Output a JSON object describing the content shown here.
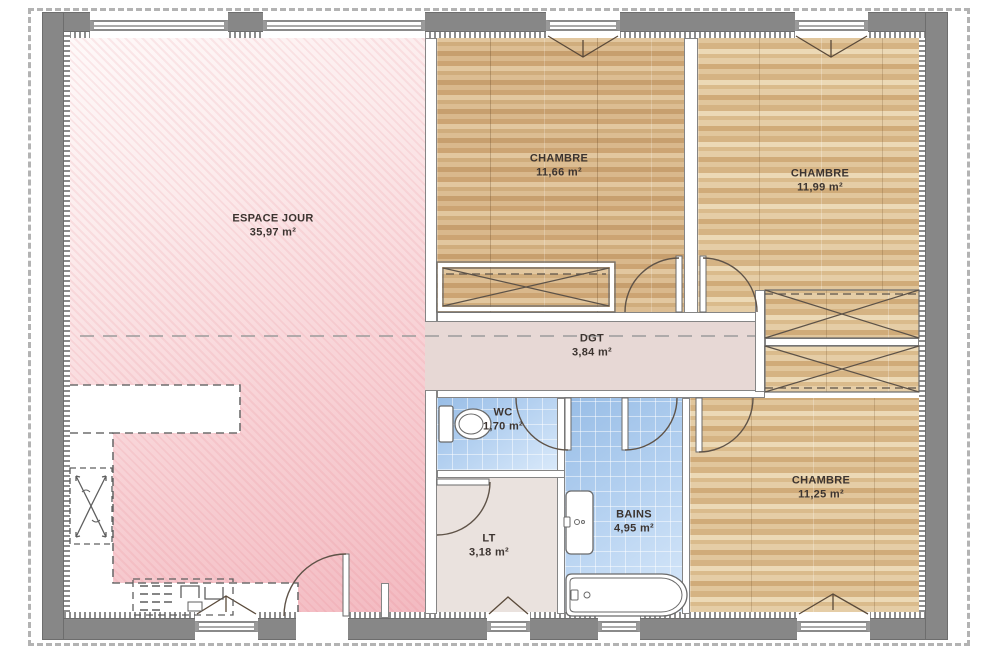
{
  "plan": {
    "title": "Plan de maison - rez-de-chaussée",
    "rooms": {
      "espaceJour": {
        "name": "ESPACE JOUR",
        "area": "35,97 m²"
      },
      "chambre1": {
        "name": "CHAMBRE",
        "area": "11,66 m²"
      },
      "chambre2": {
        "name": "CHAMBRE",
        "area": "11,99 m²"
      },
      "degagement": {
        "name": "DGT",
        "area": "3,84 m²"
      },
      "wc": {
        "name": "WC",
        "area": "1,70 m²"
      },
      "lt": {
        "name": "LT",
        "area": "3,18 m²"
      },
      "bains": {
        "name": "BAINS",
        "area": "4,95 m²"
      },
      "chambre3": {
        "name": "CHAMBRE",
        "area": "11,25 m²"
      }
    },
    "colors": {
      "exterior_wall": "#878787",
      "living_pink": "#f3bac1",
      "hallway_rose": "#e7d8d5",
      "bathroom_blue": "#aecdee",
      "bedroom_wood": "#d9b88c",
      "laundry_beige": "#eae2de",
      "boundary_dash": "#b3b3b3"
    }
  }
}
